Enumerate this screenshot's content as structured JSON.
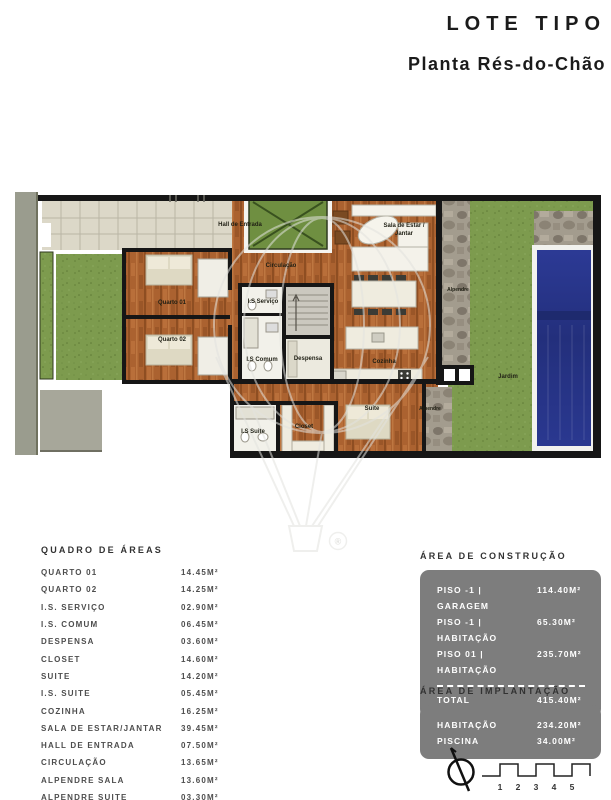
{
  "header": {
    "title": "LOTE TIPO",
    "subtitle": "Planta Rés-do-Chão"
  },
  "plan": {
    "labels": {
      "hall": "Hall de Entrada",
      "circulacao": "Circulação",
      "sala_line1": "Sala de Estar /",
      "sala_line2": "Jantar",
      "is_servico": "I.S Serviço",
      "is_comum": "I.S Comum",
      "despensa": "Despensa",
      "cozinha": "Cozinha",
      "quarto01": "Quarto 01",
      "quarto02": "Quarto 02",
      "suite": "Suite",
      "is_suite": "I.S Suite",
      "closet": "Closet",
      "alpendre_sala": "Alpendre",
      "alpendre_suite": "Alpendre",
      "jardim": "Jardim"
    },
    "watermark_registered": "®"
  },
  "areas_table": {
    "title": "QUADRO DE ÁREAS",
    "rows": [
      {
        "label": "QUARTO 01",
        "value": "14.45M²"
      },
      {
        "label": "QUARTO 02",
        "value": "14.25M²"
      },
      {
        "label": "I.S. SERVIÇO",
        "value": "02.90M²"
      },
      {
        "label": "I.S. COMUM",
        "value": "06.45M²"
      },
      {
        "label": "DESPENSA",
        "value": "03.60M²"
      },
      {
        "label": "CLOSET",
        "value": "14.60M²"
      },
      {
        "label": "SUITE",
        "value": "14.20M²"
      },
      {
        "label": "I.S. SUITE",
        "value": "05.45M²"
      },
      {
        "label": "COZINHA",
        "value": "16.25M²"
      },
      {
        "label": "SALA DE ESTAR/JANTAR",
        "value": "39.45M²"
      },
      {
        "label": "HALL DE ENTRADA",
        "value": "07.50M²"
      },
      {
        "label": "CIRCULAÇÃO",
        "value": "13.65M²"
      },
      {
        "label": "ALPENDRE SALA",
        "value": "13.60M²"
      },
      {
        "label": "ALPENDRE SUITE",
        "value": "03.30M²"
      }
    ]
  },
  "construction": {
    "title": "ÁREA DE CONSTRUÇÃO",
    "rows": [
      {
        "label": "PISO -1 | GARAGEM",
        "value": "114.40M²"
      },
      {
        "label": "PISO -1 | HABITAÇÃO",
        "value": "65.30M²"
      },
      {
        "label": "PISO 01 | HABITAÇÃO",
        "value": "235.70M²"
      }
    ],
    "total": {
      "label": "TOTAL",
      "value": "415.40M²"
    }
  },
  "implantation": {
    "title": "ÁREA DE IMPLANTAÇÃO",
    "rows": [
      {
        "label": "HABITAÇÃO",
        "value": "234.20M²"
      },
      {
        "label": "PISCINA",
        "value": "34.00M²"
      }
    ]
  },
  "scalebar": {
    "ticks": [
      "1",
      "2",
      "3",
      "4",
      "5"
    ]
  }
}
